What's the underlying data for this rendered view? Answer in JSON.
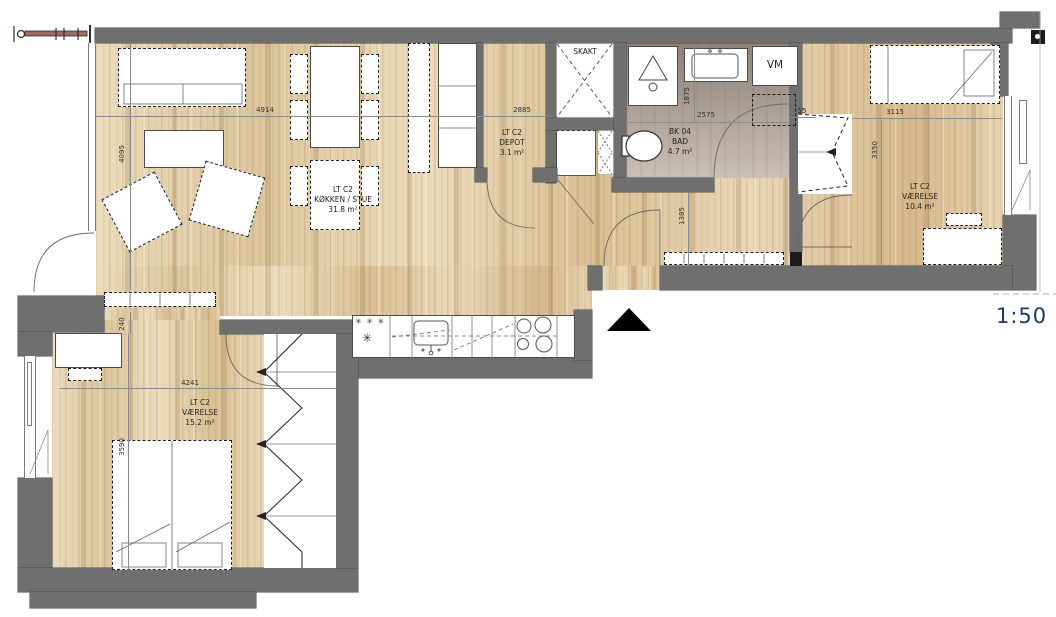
{
  "plan": {
    "scale_label": "1:50",
    "shaft_label": "SKAKT",
    "washer_label": "VM",
    "rooms": [
      {
        "code": "LT C2",
        "name": "KØKKEN / STUE",
        "area": "31.8 m²"
      },
      {
        "code": "LT C2",
        "name": "DEPOT",
        "area": "3.1 m²"
      },
      {
        "code": "BK 04",
        "name": "BAD",
        "area": "4.7 m²"
      },
      {
        "code": "LT C2",
        "name": "VÆRELSE",
        "area": "10.4 m²"
      },
      {
        "code": "LT C2",
        "name": "VÆRELSE",
        "area": "15.2 m²"
      }
    ],
    "dimensions_mm": {
      "living_width": "4914",
      "living_depth": "4095",
      "depot_span": "2885",
      "bath_width": "2575",
      "bath_depth": "1875",
      "niche_offset": "55",
      "bedroom_east_width": "3115",
      "bedroom_east_depth": "3350",
      "hall_width": "1385",
      "cabinet_depth": "240",
      "bedroom_south_width": "4241",
      "bedroom_south_depth": "3590"
    },
    "symbols": {
      "freezer_stars": "✳ ✳ ✳",
      "fridge_star": "✳"
    },
    "colors": {
      "wall": "#6f6f6f",
      "wood_floor": "#e7d5b5",
      "bath_floor": "#b0a299",
      "scale_text": "#1e3a66"
    }
  }
}
